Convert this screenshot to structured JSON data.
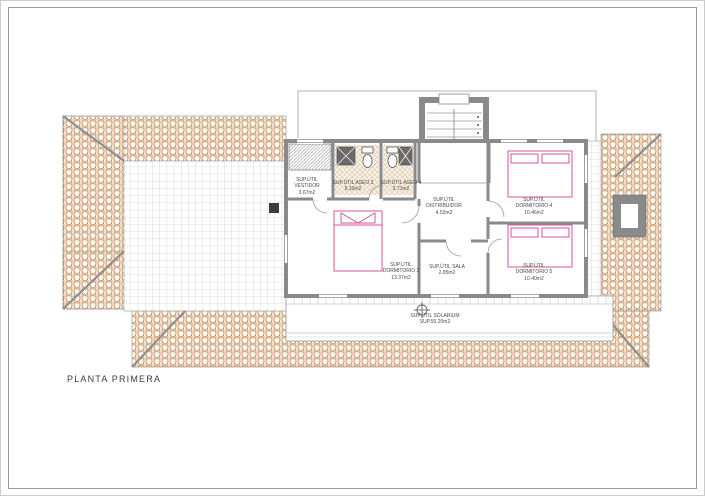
{
  "sheet": {
    "title": "PLANTA PRIMERA"
  },
  "plan": {
    "rooms": [
      {
        "id": "vestidor",
        "label": "SUP.ÚTIL VESTIDOR",
        "area": "3.67m2"
      },
      {
        "id": "aseo-3",
        "label": "SUP.ÚTIL ASEO 3",
        "area": "5.10m2"
      },
      {
        "id": "aseo-4",
        "label": "SUP.ÚTIL ASEO 4",
        "area": "3.71m2"
      },
      {
        "id": "distribuidor",
        "label": "SUP.ÚTIL DISTRIBUIDOR",
        "area": "4.52m2"
      },
      {
        "id": "dormitorio-4",
        "label": "SUP.ÚTIL DORMITORIO 4",
        "area": "10.46m2"
      },
      {
        "id": "dormitorio-5",
        "label": "SUP.ÚTIL DORMITORIO 5",
        "area": "10.40m2"
      },
      {
        "id": "dormitorio-3",
        "label": "SUP.ÚTIL DORMITORIO 3",
        "area": "13.37m2"
      },
      {
        "id": "sala",
        "label": "SUP.ÚTIL SALA",
        "area": "2.85m2"
      },
      {
        "id": "solarium",
        "label": "SUP.ÚTIL SOLARIUM",
        "area": "SUP.50.20m2"
      }
    ],
    "colors": {
      "roof_tile_line": "#c0763d",
      "terrace_grid_line": "#bcbcbc",
      "wall": "#8a8a8a",
      "furniture_pink": "#d4549c"
    }
  }
}
